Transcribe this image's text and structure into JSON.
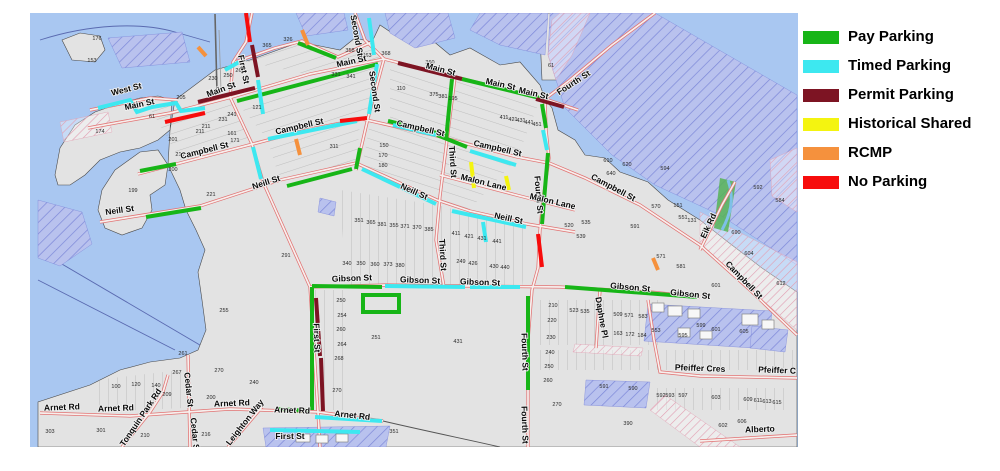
{
  "legend": {
    "items": [
      {
        "label": "Pay Parking",
        "color": "#17b517"
      },
      {
        "label": "Timed Parking",
        "color": "#3de8f0"
      },
      {
        "label": "Permit Parking",
        "color": "#7d1423"
      },
      {
        "label": "Historical Shared",
        "color": "#f4f410"
      },
      {
        "label": "RCMP",
        "color": "#f5913d"
      },
      {
        "label": "No Parking",
        "color": "#f70c0c"
      }
    ]
  },
  "map": {
    "colors": {
      "Pay": "#17b517",
      "Timed": "#3de8f0",
      "Permit": "#7d1423",
      "Historical": "#f4f410",
      "RCMP": "#f5913d",
      "No": "#f70c0c",
      "water": "#a9c7f1",
      "land": "#e3e3e3",
      "street": "#e06868"
    },
    "street_labels": [
      [
        "West St",
        127,
        92,
        -14
      ],
      [
        "Main St",
        140,
        107,
        -12
      ],
      [
        "Main St",
        222,
        92,
        -20
      ],
      [
        "Main St",
        352,
        64,
        -13
      ],
      [
        "Main St",
        440,
        72,
        15
      ],
      [
        "Main St",
        500,
        87,
        13
      ],
      [
        "Main St",
        533,
        96,
        13
      ],
      [
        "Fourth St",
        575,
        85,
        -33
      ],
      [
        "First St",
        241,
        70,
        78
      ],
      [
        "Second St",
        354,
        36,
        80
      ],
      [
        "Second St",
        372,
        92,
        82
      ],
      [
        "Third St",
        450,
        162,
        86
      ],
      [
        "Third St",
        440,
        255,
        87
      ],
      [
        "Fourth St",
        536,
        195,
        85
      ],
      [
        "Campbell St",
        205,
        153,
        -14
      ],
      [
        "Campbell St",
        300,
        129,
        -13
      ],
      [
        "Campbell St",
        420,
        131,
        13
      ],
      [
        "Campbell St",
        497,
        151,
        13
      ],
      [
        "Campbell St",
        612,
        190,
        28
      ],
      [
        "Campbell St",
        742,
        282,
        46
      ],
      [
        "Neill St",
        120,
        213,
        -8
      ],
      [
        "Neill St",
        267,
        185,
        -18
      ],
      [
        "Neill St",
        413,
        194,
        24
      ],
      [
        "Neill St",
        508,
        221,
        12
      ],
      [
        "Malon Lane",
        483,
        185,
        14
      ],
      [
        "Malon Lane",
        552,
        204,
        13
      ],
      [
        "Gibson St",
        352,
        281,
        -2
      ],
      [
        "Gibson St",
        420,
        283,
        2
      ],
      [
        "Gibson St",
        480,
        285,
        2
      ],
      [
        "Gibson St",
        630,
        290,
        5
      ],
      [
        "Gibson St",
        690,
        297,
        6
      ],
      [
        "Fourth St",
        522,
        352,
        88
      ],
      [
        "Fourth St",
        522,
        425,
        88
      ],
      [
        "First St",
        314,
        338,
        88
      ],
      [
        "First St",
        290,
        439,
        0
      ],
      [
        "Arnet Rd",
        62,
        410,
        -2
      ],
      [
        "Arnet Rd",
        116,
        411,
        -2
      ],
      [
        "Arnet Rd",
        232,
        406,
        -2
      ],
      [
        "Arnet Rd",
        292,
        413,
        2
      ],
      [
        "Arnet Rd",
        352,
        418,
        6
      ],
      [
        "Cedar St",
        186,
        390,
        84
      ],
      [
        "Cedar S",
        192,
        434,
        84
      ],
      [
        "Tonquin Park Rd",
        143,
        419,
        -56
      ],
      [
        "Leighton Way",
        247,
        424,
        -52
      ],
      [
        "Daphne Pl",
        599,
        318,
        80
      ],
      [
        "Pfeiffer Cres",
        700,
        371,
        2
      ],
      [
        "Pfeiffer C",
        777,
        373,
        2
      ],
      [
        "Alberto",
        760,
        432,
        -2
      ],
      [
        "Eik Rd",
        711,
        227,
        -65
      ]
    ],
    "parcel_numbers": [
      [
        "176",
        97,
        40
      ],
      [
        "153",
        92,
        62
      ],
      [
        "174",
        100,
        133
      ],
      [
        "61",
        152,
        118
      ],
      [
        "199",
        133,
        192
      ],
      [
        "205",
        181,
        99
      ],
      [
        "201",
        173,
        141
      ],
      [
        "211",
        200,
        133
      ],
      [
        "210",
        180,
        156
      ],
      [
        "200",
        173,
        171
      ],
      [
        "230",
        213,
        80
      ],
      [
        "250",
        228,
        77
      ],
      [
        "260",
        240,
        72
      ],
      [
        "221",
        211,
        196
      ],
      [
        "291",
        286,
        257
      ],
      [
        "255",
        224,
        312
      ],
      [
        "270",
        219,
        372
      ],
      [
        "240",
        254,
        384
      ],
      [
        "267",
        177,
        374
      ],
      [
        "261",
        183,
        355
      ],
      [
        "209",
        167,
        396
      ],
      [
        "200",
        211,
        399
      ],
      [
        "100",
        116,
        388
      ],
      [
        "120",
        136,
        386
      ],
      [
        "140",
        156,
        387
      ],
      [
        "303",
        50,
        433
      ],
      [
        "301",
        101,
        432
      ],
      [
        "216",
        206,
        436
      ],
      [
        "210",
        145,
        437
      ],
      [
        "365",
        267,
        47
      ],
      [
        "326",
        288,
        41
      ],
      [
        "358",
        350,
        52
      ],
      [
        "363",
        367,
        57
      ],
      [
        "368",
        386,
        55
      ],
      [
        "360",
        430,
        64
      ],
      [
        "61",
        551,
        67
      ],
      [
        "331",
        336,
        76
      ],
      [
        "341",
        351,
        78
      ],
      [
        "110",
        401,
        90
      ],
      [
        "375",
        434,
        96
      ],
      [
        "381",
        443,
        98
      ],
      [
        "195",
        453,
        100
      ],
      [
        "121",
        257,
        109
      ],
      [
        "241",
        232,
        116
      ],
      [
        "231",
        223,
        121
      ],
      [
        "211",
        206,
        128
      ],
      [
        "161",
        232,
        135
      ],
      [
        "171",
        235,
        142
      ],
      [
        "150",
        384,
        147
      ],
      [
        "170",
        383,
        157
      ],
      [
        "180",
        383,
        167
      ],
      [
        "311",
        334,
        148
      ],
      [
        "411",
        504,
        119
      ],
      [
        "421",
        513,
        121
      ],
      [
        "431",
        521,
        122
      ],
      [
        "441",
        529,
        124
      ],
      [
        "451",
        537,
        126
      ],
      [
        "610",
        608,
        162
      ],
      [
        "620",
        627,
        166
      ],
      [
        "640",
        611,
        175
      ],
      [
        "594",
        665,
        170
      ],
      [
        "570",
        656,
        208
      ],
      [
        "535",
        586,
        224
      ],
      [
        "520",
        569,
        227
      ],
      [
        "539",
        581,
        238
      ],
      [
        "551",
        683,
        219
      ],
      [
        "591",
        635,
        228
      ],
      [
        "592",
        758,
        189
      ],
      [
        "584",
        780,
        202
      ],
      [
        "690",
        736,
        234
      ],
      [
        "604",
        749,
        255
      ],
      [
        "612",
        781,
        285
      ],
      [
        "601",
        716,
        287
      ],
      [
        "581",
        681,
        268
      ],
      [
        "571",
        661,
        258
      ],
      [
        "151",
        678,
        207
      ],
      [
        "131",
        692,
        222
      ],
      [
        "351",
        359,
        222
      ],
      [
        "365",
        371,
        224
      ],
      [
        "381",
        382,
        226
      ],
      [
        "355",
        394,
        227
      ],
      [
        "371",
        405,
        228
      ],
      [
        "370",
        417,
        229
      ],
      [
        "385",
        429,
        231
      ],
      [
        "340",
        347,
        265
      ],
      [
        "350",
        361,
        265
      ],
      [
        "360",
        375,
        266
      ],
      [
        "373",
        388,
        266
      ],
      [
        "380",
        400,
        267
      ],
      [
        "249",
        461,
        263
      ],
      [
        "426",
        473,
        265
      ],
      [
        "430",
        494,
        268
      ],
      [
        "440",
        505,
        269
      ],
      [
        "411",
        456,
        235
      ],
      [
        "421",
        469,
        238
      ],
      [
        "431",
        482,
        240
      ],
      [
        "441",
        497,
        243
      ],
      [
        "250",
        341,
        302
      ],
      [
        "254",
        342,
        317
      ],
      [
        "260",
        341,
        331
      ],
      [
        "264",
        342,
        346
      ],
      [
        "268",
        339,
        360
      ],
      [
        "270",
        337,
        392
      ],
      [
        "251",
        376,
        339
      ],
      [
        "431",
        458,
        343
      ],
      [
        "351",
        394,
        433
      ],
      [
        "390",
        628,
        425
      ],
      [
        "210",
        553,
        307
      ],
      [
        "220",
        552,
        322
      ],
      [
        "230",
        551,
        339
      ],
      [
        "240",
        550,
        354
      ],
      [
        "250",
        549,
        368
      ],
      [
        "260",
        548,
        382
      ],
      [
        "270",
        557,
        406
      ],
      [
        "523",
        574,
        312
      ],
      [
        "535",
        585,
        313
      ],
      [
        "509",
        618,
        316
      ],
      [
        "571",
        629,
        317
      ],
      [
        "583",
        643,
        318
      ],
      [
        "163",
        618,
        335
      ],
      [
        "172",
        630,
        336
      ],
      [
        "184",
        642,
        337
      ],
      [
        "553",
        656,
        332
      ],
      [
        "595",
        683,
        337
      ],
      [
        "599",
        701,
        327
      ],
      [
        "601",
        716,
        331
      ],
      [
        "605",
        744,
        333
      ],
      [
        "591",
        604,
        388
      ],
      [
        "590",
        633,
        390
      ],
      [
        "592",
        661,
        397
      ],
      [
        "593",
        670,
        397
      ],
      [
        "597",
        683,
        397
      ],
      [
        "603",
        716,
        399
      ],
      [
        "609",
        748,
        401
      ],
      [
        "611",
        758,
        402
      ],
      [
        "613",
        767,
        403
      ],
      [
        "615",
        777,
        404
      ],
      [
        "606",
        742,
        423
      ],
      [
        "602",
        723,
        427
      ]
    ],
    "parking_segments": [
      {
        "type": "Pay",
        "pts": "237,101 378,64"
      },
      {
        "type": "Pay",
        "pts": "462,79 540,98"
      },
      {
        "type": "Pay",
        "pts": "298,43 336,58"
      },
      {
        "type": "Pay",
        "pts": "388,121 437,133"
      },
      {
        "type": "Pay",
        "pts": "437,135 467,147"
      },
      {
        "type": "Pay",
        "pts": "542,104 546,128"
      },
      {
        "type": "Pay",
        "pts": "548,153 542,224"
      },
      {
        "type": "Pay",
        "pts": "528,296 528,390"
      },
      {
        "type": "Pay",
        "pts": "565,287 697,297"
      },
      {
        "type": "Pay",
        "pts": "312,286 382,287"
      },
      {
        "type": "Pay",
        "pts": "312,287 312,410"
      },
      {
        "type": "Pay",
        "pts": "276,409 309,411"
      },
      {
        "type": "Pay",
        "pts": "146,217 201,208"
      },
      {
        "type": "Pay",
        "pts": "140,171 176,164"
      },
      {
        "type": "Pay",
        "pts": "287,186 352,169"
      },
      {
        "type": "Pay",
        "pts": "360,148 356,169"
      },
      {
        "type": "Pay",
        "pts": "452,79 446,140"
      },
      {
        "type": "Timed",
        "pts": "98,108 130,100 137,112 152,107 176,103 181,111 205,108"
      },
      {
        "type": "Timed",
        "pts": "258,80 263,114"
      },
      {
        "type": "Timed",
        "pts": "268,139 357,121"
      },
      {
        "type": "Timed",
        "pts": "393,125 436,135"
      },
      {
        "type": "Timed",
        "pts": "470,151 516,165"
      },
      {
        "type": "Timed",
        "pts": "377,64 369,114"
      },
      {
        "type": "Timed",
        "pts": "362,169 436,204"
      },
      {
        "type": "Timed",
        "pts": "452,211 526,227"
      },
      {
        "type": "Timed",
        "pts": "253,147 261,179"
      },
      {
        "type": "Timed",
        "pts": "385,286 465,287"
      },
      {
        "type": "Timed",
        "pts": "470,287 520,287"
      },
      {
        "type": "Timed",
        "pts": "369,18 374,55"
      },
      {
        "type": "Timed",
        "pts": "225,70 239,62"
      },
      {
        "type": "Timed",
        "pts": "543,130 547,150"
      },
      {
        "type": "Timed",
        "pts": "483,222 486,242"
      },
      {
        "type": "Timed",
        "pts": "315,417 382,421"
      },
      {
        "type": "Timed",
        "pts": "270,430 360,432"
      },
      {
        "type": "Permit",
        "pts": "198,102 255,88"
      },
      {
        "type": "Permit",
        "pts": "252,45 258,77"
      },
      {
        "type": "Permit",
        "pts": "398,63 462,79"
      },
      {
        "type": "Permit",
        "pts": "536,99 564,107"
      },
      {
        "type": "Permit",
        "pts": "316,298 320,356"
      },
      {
        "type": "Permit",
        "pts": "321,358 323,411"
      },
      {
        "type": "Historical",
        "pts": "471,162 474,188"
      },
      {
        "type": "Historical",
        "pts": "506,176 509,190"
      },
      {
        "type": "RCMP",
        "pts": "302,30 308,45"
      },
      {
        "type": "RCMP",
        "pts": "296,139 300,155"
      },
      {
        "type": "RCMP",
        "pts": "653,258 658,270"
      },
      {
        "type": "RCMP",
        "pts": "198,47 206,56"
      },
      {
        "type": "No",
        "pts": "165,122 205,113"
      },
      {
        "type": "No",
        "pts": "340,121 367,118"
      },
      {
        "type": "No",
        "pts": "538,234 542,267"
      },
      {
        "type": "No",
        "pts": "246,13 250,42"
      }
    ],
    "parking_lots": [
      {
        "type": "Pay",
        "x": 363,
        "y": 295,
        "w": 36,
        "h": 17
      }
    ]
  }
}
